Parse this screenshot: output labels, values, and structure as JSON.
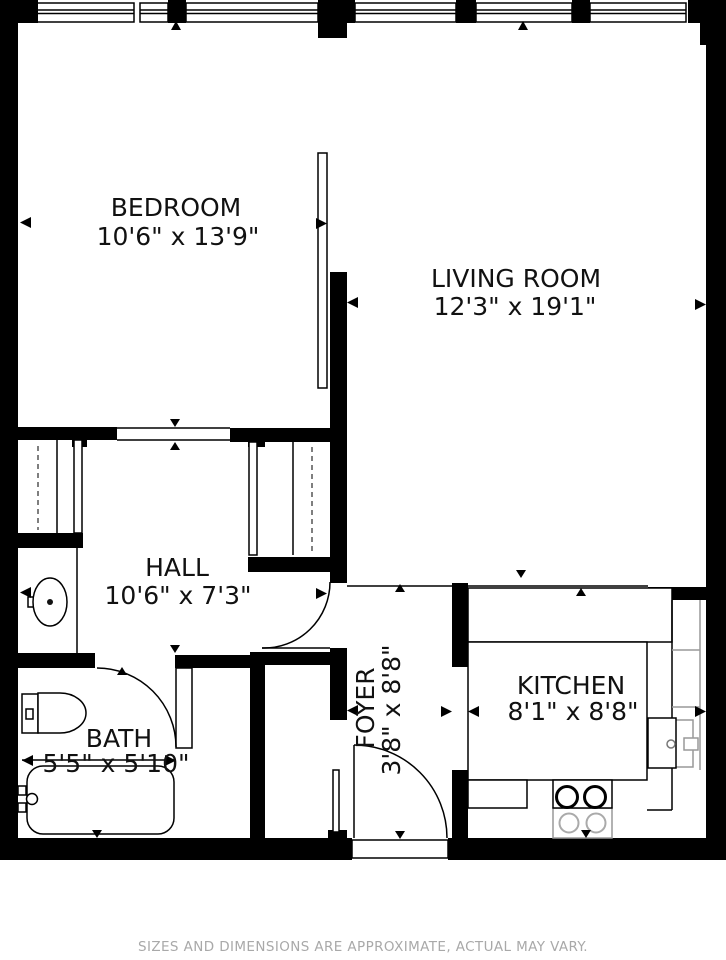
{
  "floorplan": {
    "rooms": {
      "bedroom": {
        "name": "BEDROOM",
        "dims": "10'6\" x 13'9\""
      },
      "living": {
        "name": "LIVING ROOM",
        "dims": "12'3\" x 19'1\""
      },
      "hall": {
        "name": "HALL",
        "dims": "10'6\" x 7'3\""
      },
      "bath": {
        "name": "BATH",
        "dims": "5'5\" x 5'10\""
      },
      "foyer": {
        "name": "FOYER",
        "dims": "3'8\" x 8'8\""
      },
      "kitchen": {
        "name": "KITCHEN",
        "dims": "8'1\" x 8'8\""
      }
    },
    "disclaimer": "SIZES AND DIMENSIONS ARE APPROXIMATE, ACTUAL MAY VARY.",
    "colors": {
      "wall": "#000000",
      "background": "#ffffff",
      "disclaimer_text": "#a9a9a9",
      "fixture_gray": "#999999"
    }
  }
}
